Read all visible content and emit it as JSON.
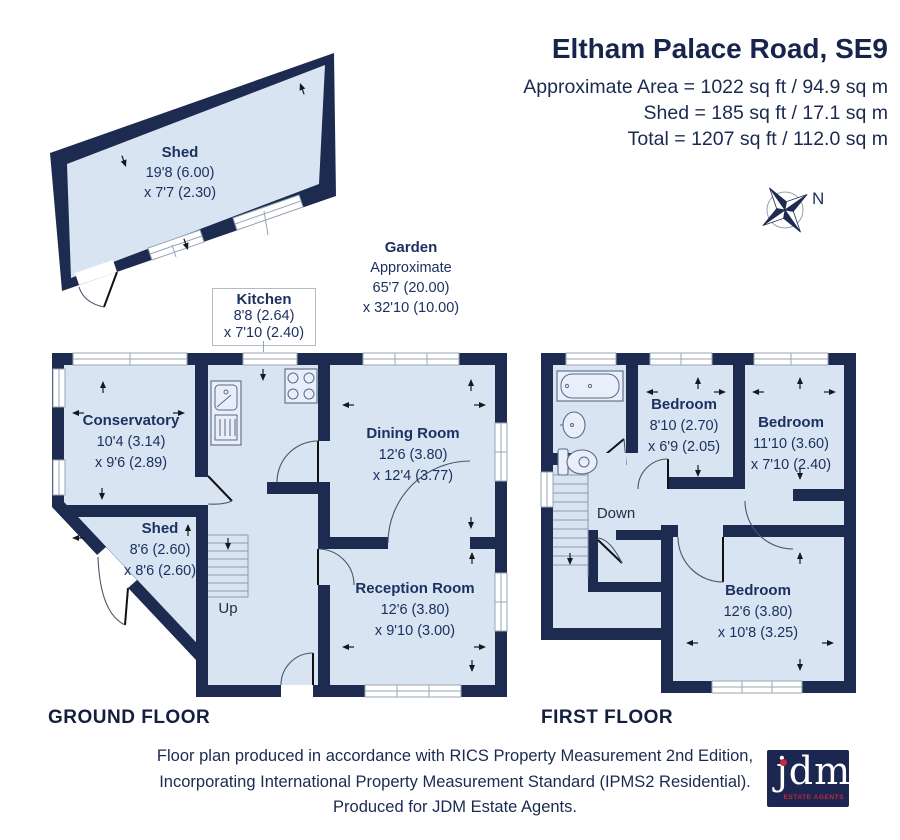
{
  "header": {
    "title": "Eltham Palace Road, SE9",
    "area_lines": [
      "Approximate Area = 1022 sq ft / 94.9 sq m",
      "Shed = 185 sq ft / 17.1 sq m",
      "Total = 1207 sq ft / 112.0 sq m"
    ]
  },
  "compass": {
    "north_label": "N"
  },
  "garden": {
    "name": "Garden",
    "line1": "Approximate",
    "line2": "65'7 (20.00)",
    "line3": "x 32'10 (10.00)"
  },
  "kitchen_callout": {
    "name": "Kitchen",
    "dim1": "8'8 (2.64)",
    "dim2": "x 7'10 (2.40)"
  },
  "outbuilding": {
    "name": "Shed",
    "dim1": "19'8 (6.00)",
    "dim2": "x 7'7 (2.30)"
  },
  "ground_floor": {
    "caption": "GROUND FLOOR",
    "stairs_label": "Up",
    "rooms": {
      "conservatory": {
        "name": "Conservatory",
        "dim1": "10'4 (3.14)",
        "dim2": "x 9'6 (2.89)"
      },
      "shed": {
        "name": "Shed",
        "dim1": "8'6 (2.60)",
        "dim2": "x 8'6 (2.60)"
      },
      "dining": {
        "name": "Dining Room",
        "dim1": "12'6 (3.80)",
        "dim2": "x 12'4 (3.77)"
      },
      "reception": {
        "name": "Reception Room",
        "dim1": "12'6 (3.80)",
        "dim2": "x 9'10 (3.00)"
      }
    }
  },
  "first_floor": {
    "caption": "FIRST FLOOR",
    "stairs_label": "Down",
    "rooms": {
      "bedroom1": {
        "name": "Bedroom",
        "dim1": "8'10 (2.70)",
        "dim2": "x 6'9 (2.05)"
      },
      "bedroom2": {
        "name": "Bedroom",
        "dim1": "11'10 (3.60)",
        "dim2": "x 7'10 (2.40)"
      },
      "bedroom3": {
        "name": "Bedroom",
        "dim1": "12'6 (3.80)",
        "dim2": "x 10'8 (3.25)"
      }
    }
  },
  "footer": {
    "lines": [
      "Floor plan produced in accordance with RICS Property Measurement 2nd Edition,",
      "Incorporating International Property Measurement Standard (IPMS2 Residential).",
      "Produced for JDM Estate Agents."
    ]
  },
  "logo": {
    "word": "jdm",
    "tagline": "ESTATE AGENTS"
  },
  "colors": {
    "wall": "#1c2b4f",
    "room_fill": "#d8e4f2",
    "label": "#1d3160",
    "logo_red": "#c6273c"
  }
}
